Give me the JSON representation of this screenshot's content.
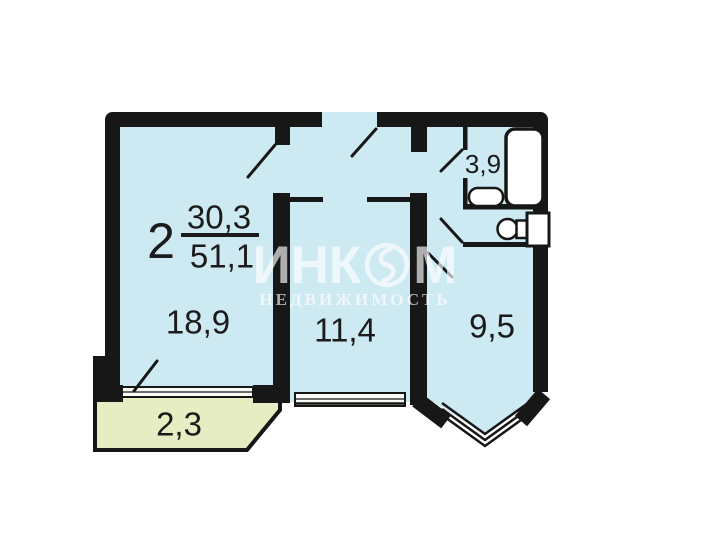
{
  "apartment": {
    "rooms_count": "2",
    "living_area": "30,3",
    "total_area": "51,1"
  },
  "rooms": [
    {
      "name": "living-room",
      "area": "18,9"
    },
    {
      "name": "bedroom",
      "area": "11,4"
    },
    {
      "name": "kitchen",
      "area": "9,5"
    },
    {
      "name": "bathroom",
      "area": "3,9"
    },
    {
      "name": "balcony",
      "area": "2,3"
    }
  ],
  "watermark": {
    "brand_prefix": "ИНК",
    "brand_suffix": "М",
    "subtitle": "НЕДВИЖИМОСТЬ"
  },
  "colors": {
    "room_fill": "#cde9f2",
    "balcony_fill": "#e6edc3",
    "wall": "#171717",
    "window_fill": "#fbfcf5",
    "background": "#ffffff",
    "watermark_text": "rgba(255,255,255,0.65)"
  }
}
